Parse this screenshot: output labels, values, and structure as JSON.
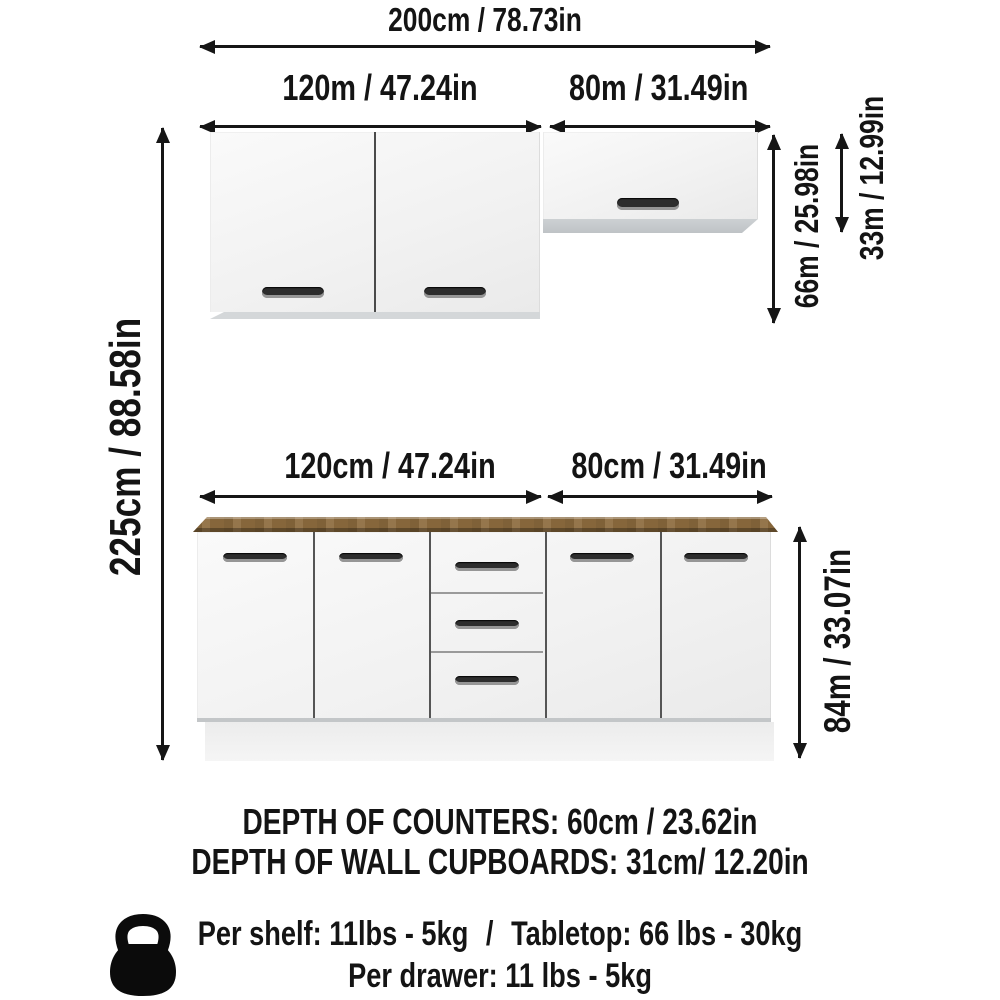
{
  "colors": {
    "background": "#ffffff",
    "line_and_text": "#161616",
    "cabinet_front": "#f4f4f4",
    "cabinet_bevel": "#c9cdd0",
    "countertop_wood": "#8d6c3e",
    "handle": "#2d2d2d"
  },
  "dimensions": {
    "total_width": "200cm / 78.73in",
    "wall_left_width": "120m / 47.24in",
    "wall_right_width": "80m / 31.49in",
    "base_left_width": "120cm / 47.24in",
    "base_right_width": "80cm / 31.49in",
    "total_height": "225cm / 88.58in",
    "wall_cabinet_height": "66m / 25.98in",
    "wall_small_cabinet_height": "33m / 12.99in",
    "base_cabinet_height": "84m / 33.07in"
  },
  "notes": {
    "counter_depth": "DEPTH OF COUNTERS: 60cm / 23.62in",
    "wall_cupboard_depth": "DEPTH OF WALL CUPBOARDS: 31cm/ 12.20in"
  },
  "load_capacity": {
    "icon": "kettlebell-icon",
    "per_shelf": "Per shelf: 11lbs - 5kg",
    "separator": "/",
    "tabletop": "Tabletop: 66 lbs - 30kg",
    "per_drawer": "Per drawer: 11 lbs - 5kg"
  }
}
